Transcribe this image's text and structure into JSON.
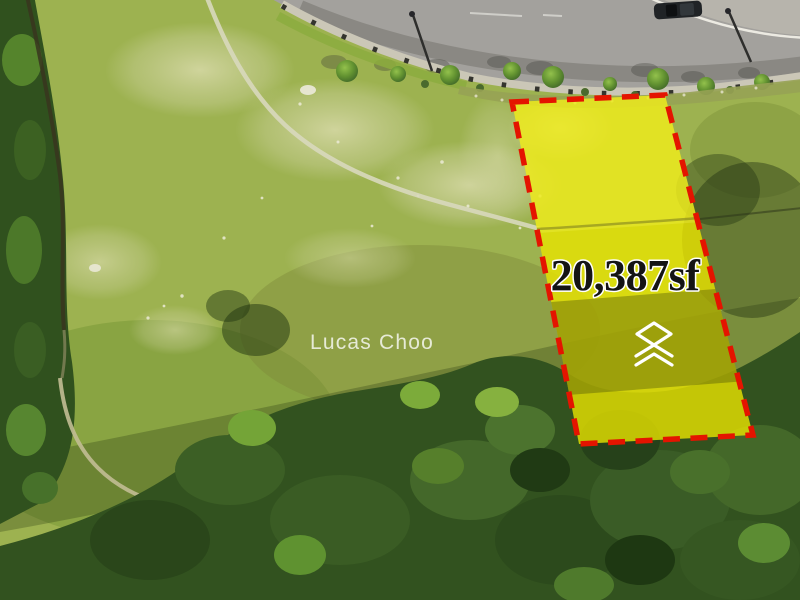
{
  "plot_overlay": {
    "area_label": "20,387sf",
    "fill_color": "#e9e400",
    "border_color": "#e41400",
    "label_color": "#141414",
    "label_outline": "#ffffff",
    "logo_icon": "stacked-chevrons-logo-icon",
    "logo_color": "#ffffff"
  },
  "watermark": {
    "text": "Lucas Choo",
    "color": "#ffffff"
  }
}
